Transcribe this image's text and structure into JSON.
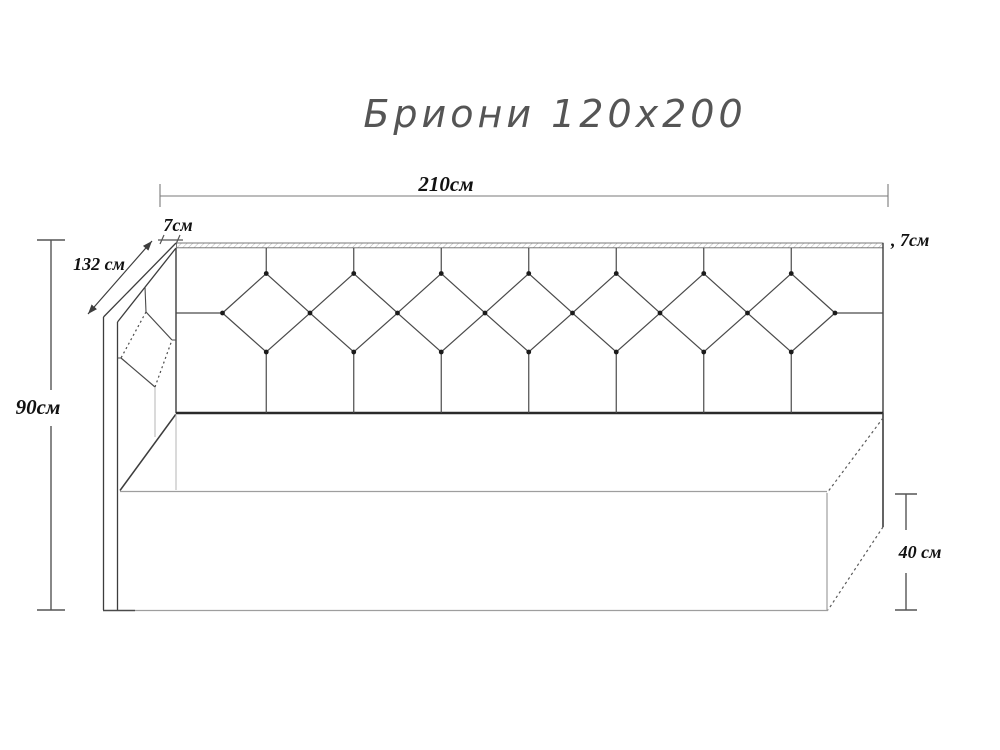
{
  "title": "Бриони 120x200",
  "drawing": {
    "product_name": "Бриони",
    "bed_size": "120x200",
    "palette": {
      "ink": "#3d3d3d",
      "bold_ink": "#2a2a2a",
      "light_line": "#9e9e9e",
      "hatch": "#b8b8b8",
      "background": "#ffffff"
    },
    "dimensions": {
      "total_width": "210см",
      "rail_thickness_left": "7см",
      "rail_thickness_right": ", 7см",
      "side_depth": "132 см",
      "headboard_height": "90см",
      "base_height": "40 см"
    }
  }
}
